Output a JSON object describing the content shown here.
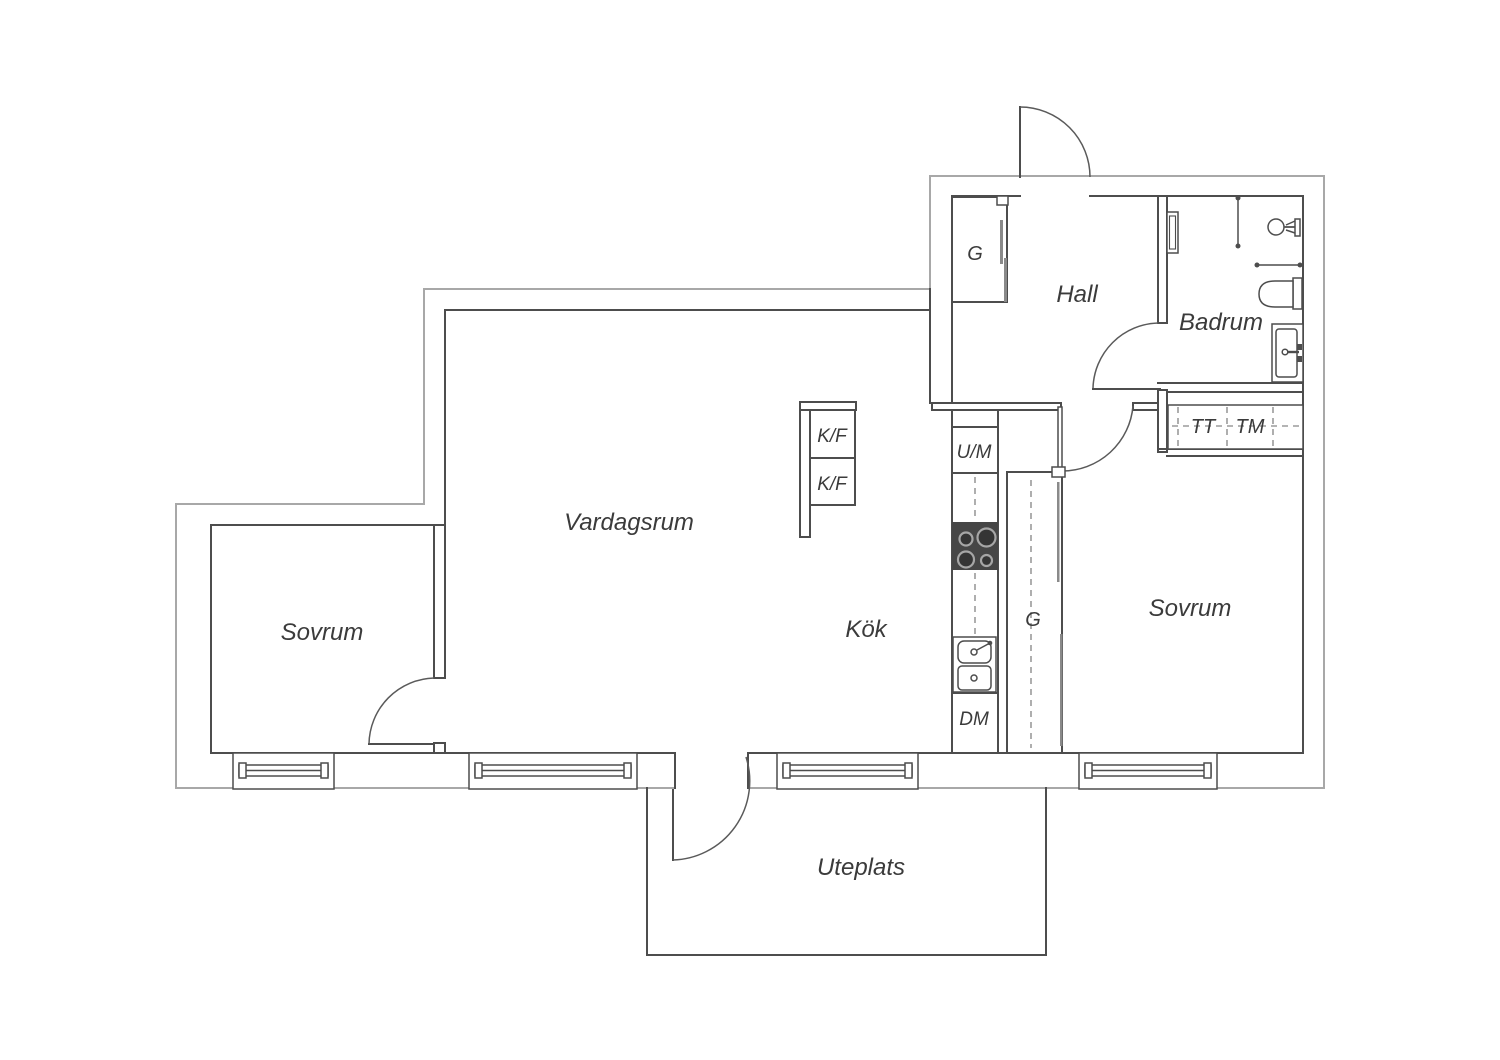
{
  "plan_title": "Apartment floor plan",
  "rooms": [
    {
      "id": "vardagsrum",
      "label": "Vardagsrum"
    },
    {
      "id": "kok",
      "label": "Kök"
    },
    {
      "id": "sovrum_left",
      "label": "Sovrum"
    },
    {
      "id": "sovrum_right",
      "label": "Sovrum"
    },
    {
      "id": "hall",
      "label": "Hall"
    },
    {
      "id": "badrum",
      "label": "Badrum"
    },
    {
      "id": "uteplats",
      "label": "Uteplats"
    }
  ],
  "appliances": [
    {
      "id": "fridge_freezer_upper",
      "label": "K/F"
    },
    {
      "id": "fridge_freezer_lower",
      "label": "K/F"
    },
    {
      "id": "oven_microwave",
      "label": "U/M"
    },
    {
      "id": "dishwasher",
      "label": "DM"
    },
    {
      "id": "wardrobe_hall",
      "label": "G"
    },
    {
      "id": "wardrobe_bedroom",
      "label": "G"
    },
    {
      "id": "tumble_dryer",
      "label": "TT"
    },
    {
      "id": "washing_machine",
      "label": "TM"
    }
  ],
  "colors": {
    "background": "#ffffff",
    "wall": "#4d4d4d",
    "envelope": "#a8a8a8",
    "dashed_marking": "#9b9b9b",
    "stove": "#464646",
    "text": "#3b3b3b"
  }
}
